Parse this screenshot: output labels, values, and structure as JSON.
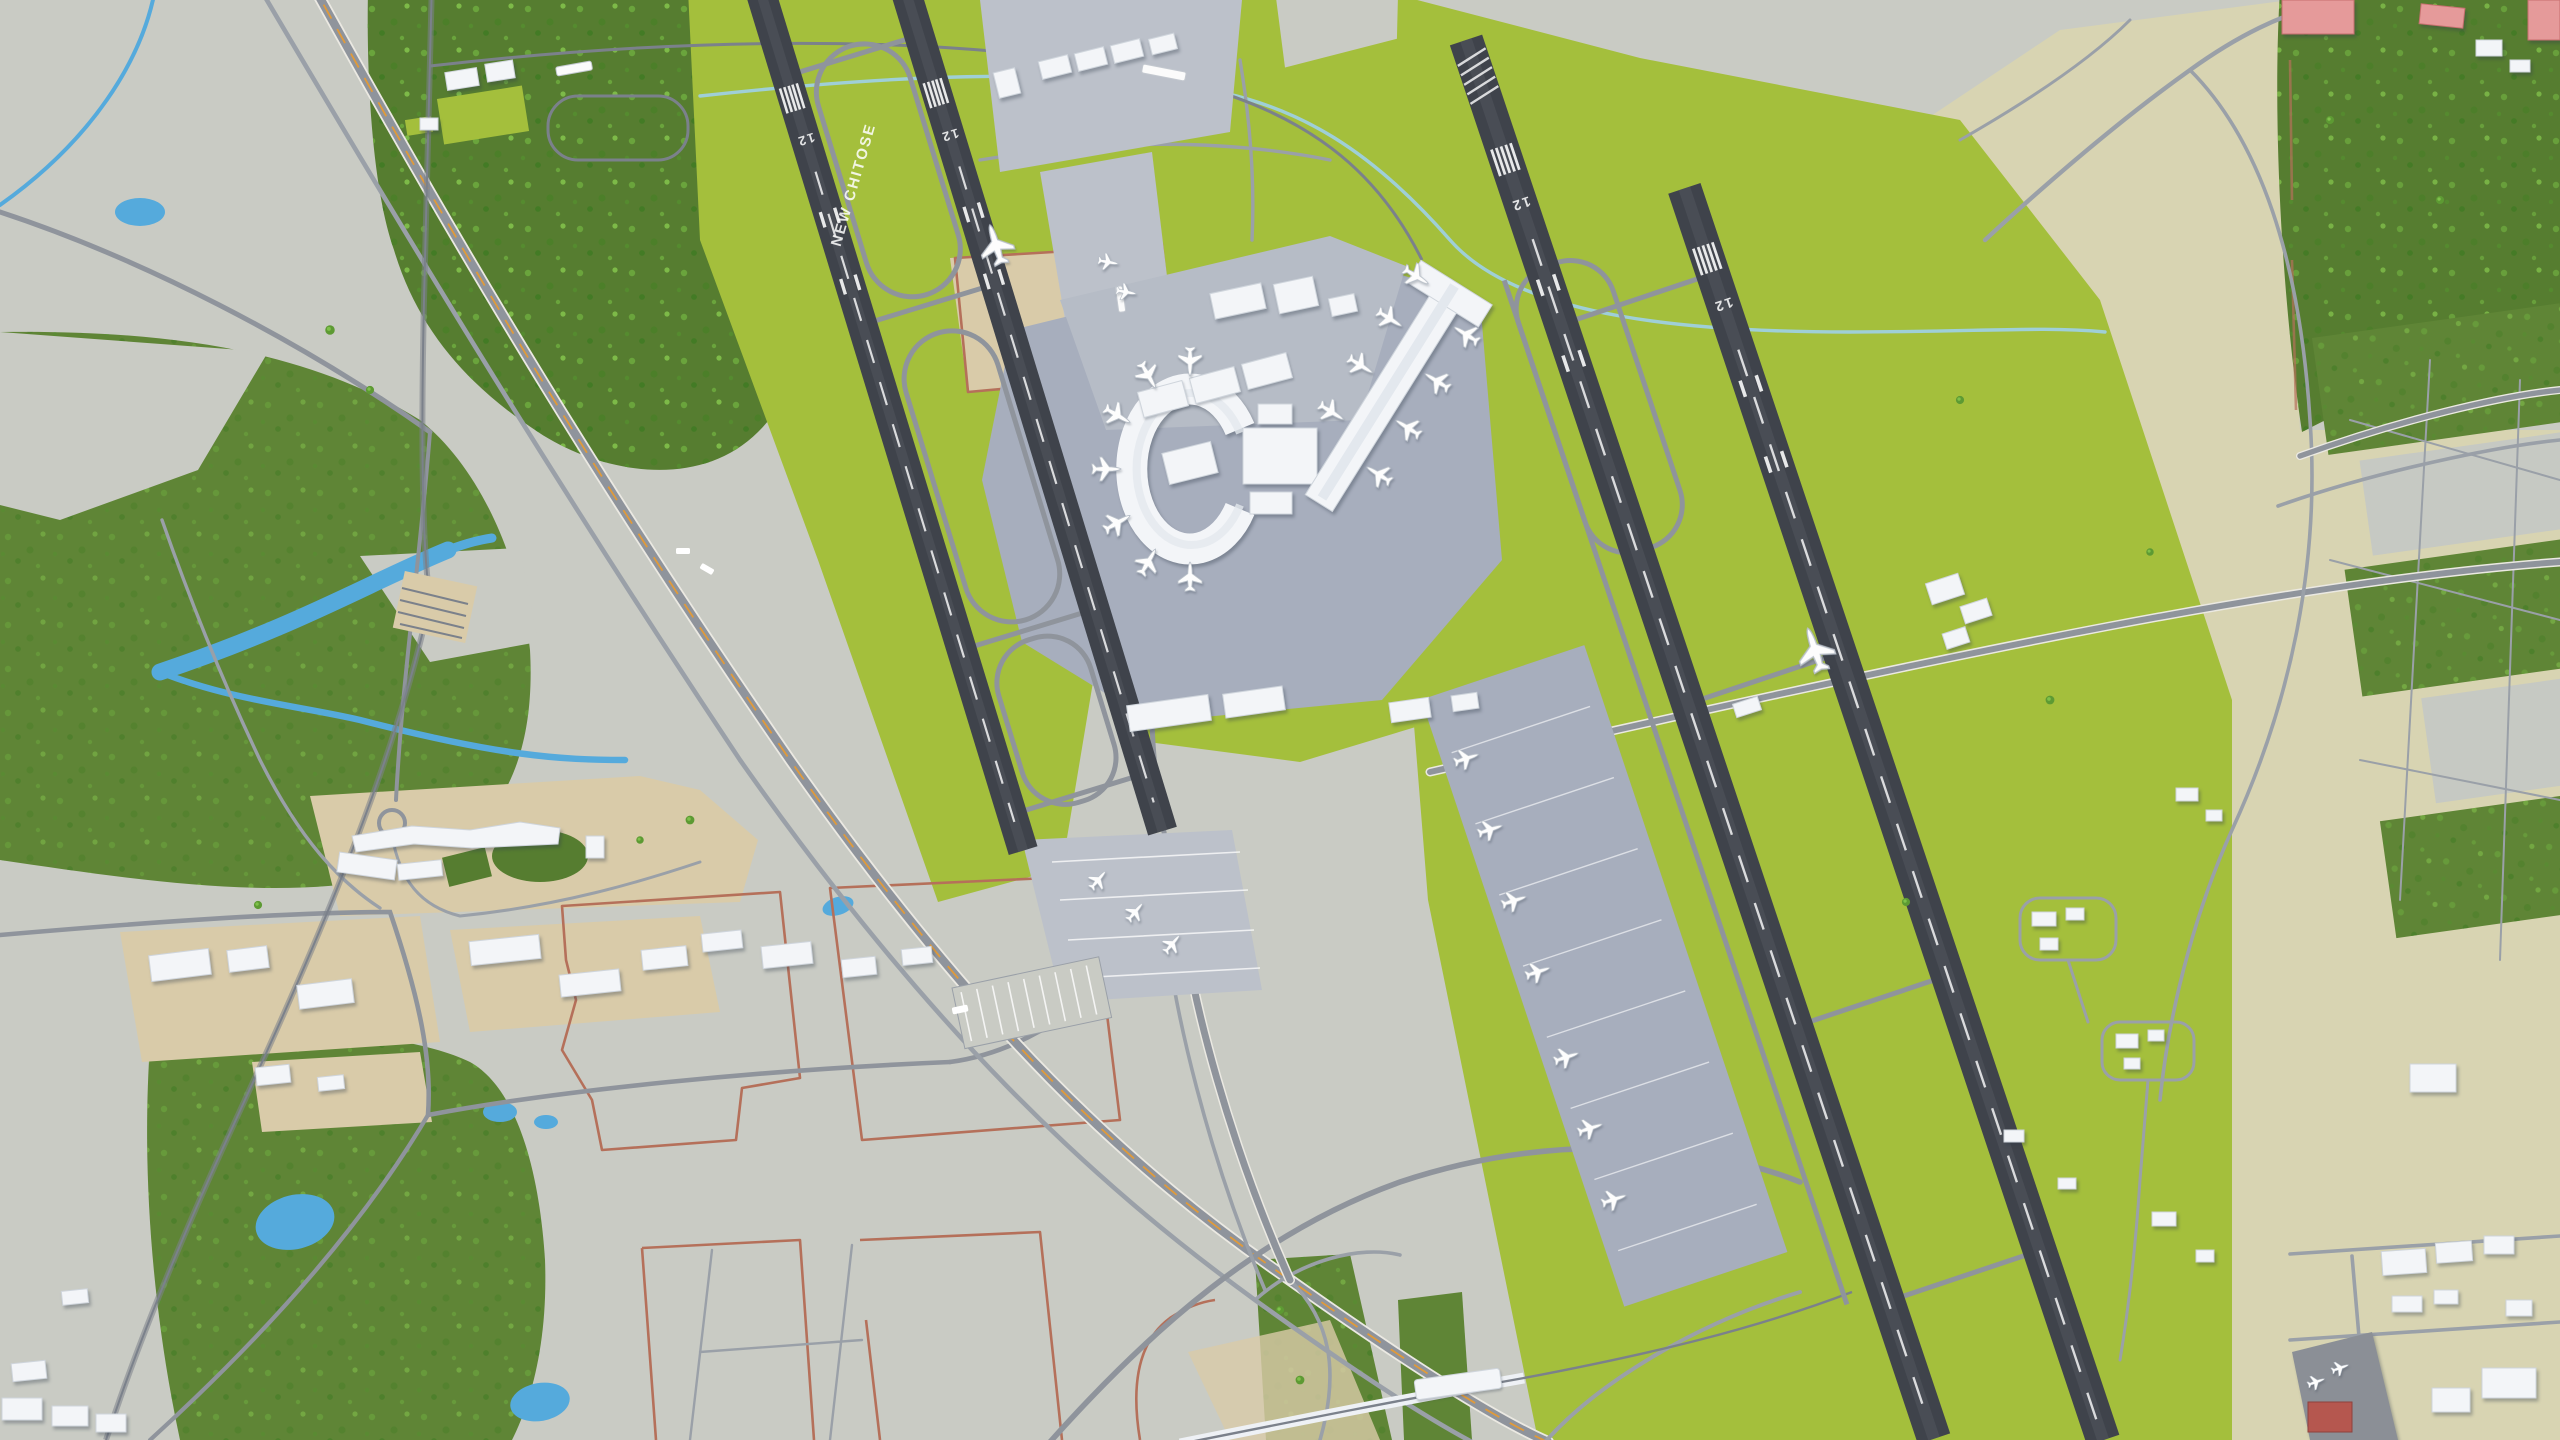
{
  "scene": {
    "type": "3d-map-render",
    "subject": "New Chitose Airport and Chitose Air Base oblique aerial 3D city model",
    "style": "low-poly stylized render, no UI chrome"
  },
  "labels": {
    "ground_label": "NEW CHITOSE",
    "runway_threshold": "12"
  },
  "colors": {
    "ground-gray": "#c9cbc4",
    "ground-khaki": "#d8d4b2",
    "forest": "#567d30",
    "grass-dark": "#5f8536",
    "grass-bright": "#a4bf3c",
    "lot-tan": "#d9cba9",
    "apron-blue": "#a7aebd",
    "apron-light": "#bcc1ca",
    "water": "#55aadc",
    "canal": "#9fd0e8",
    "runway": "#3f434b",
    "road": "#8f949c",
    "road-minor": "#9aa0a8",
    "road-casing": "#ebe9e2",
    "road-dash": "#e09a3a",
    "rail": "#7b818b",
    "parcel-red": "#b5705a",
    "bldg": "#f3f5f8",
    "bldg-edge": "#cfd5dc",
    "bldg-pink": "#e59a9a",
    "bldg-pink-edge": "#c76f6f",
    "bldg-red": "#b5574f",
    "plane": "#fdfdfd",
    "tree-light": "#7ebb46",
    "tree-dark": "#3e7a22"
  },
  "features": [
    "terminal-ring",
    "terminal-concourse",
    "airbase-runway-pair",
    "airport-runway-pair",
    "cargo-apron",
    "highway-interchange",
    "airport-rail-station",
    "forest",
    "farm-fields",
    "river",
    "ponds",
    "industrial-lots",
    "hotel-complex",
    "rail-yard"
  ]
}
